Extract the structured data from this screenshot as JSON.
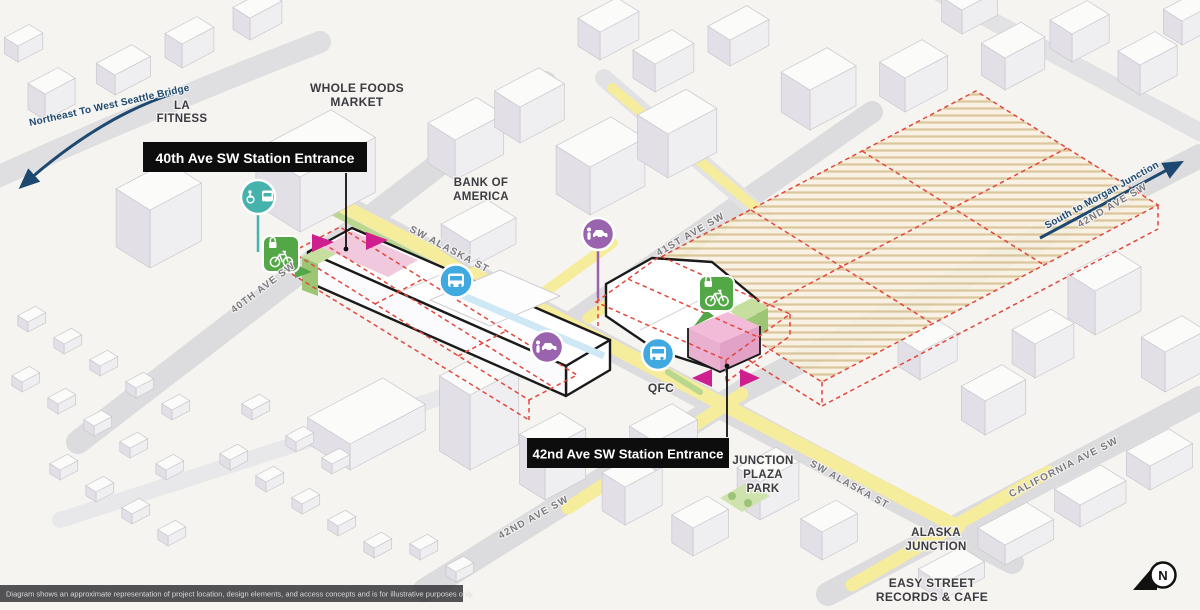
{
  "direction_arrows": {
    "to_west_seattle_bridge": "Northeast To West Seattle Bridge",
    "to_morgan_junction": "South to Morgan Junction"
  },
  "station_entrances": {
    "entrance_40th": "40th Ave SW Station Entrance",
    "entrance_42nd": "42nd Ave SW Station Entrance"
  },
  "streets": {
    "sw_alaska_st_west": "SW ALASKA ST",
    "sw_alaska_st_east": "SW ALASKA ST",
    "ave_40th": "40TH AVE SW",
    "ave_41st": "41ST AVE SW",
    "ave_42nd_south": "42ND AVE SW",
    "ave_42nd_north": "42ND AVE SW",
    "california_ave": "CALIFORNIA AVE SW"
  },
  "places": {
    "la_fitness": [
      "LA",
      "FITNESS"
    ],
    "whole_foods": [
      "WHOLE FOODS",
      "MARKET"
    ],
    "bank_of_america": [
      "BANK OF",
      "AMERICA"
    ],
    "qfc": "QFC",
    "junction_plaza_park": [
      "JUNCTION",
      "PLAZA",
      "PARK"
    ],
    "alaska_junction": [
      "ALASKA",
      "JUNCTION"
    ],
    "easy_street": [
      "EASY STREET",
      "RECORDS & CAFE"
    ]
  },
  "icons": {
    "paratransit_stop": "wheelchair-bus",
    "bus_stop_west": "bus",
    "bus_stop_east": "bus",
    "pickup_dropoff_west": "person-car",
    "pickup_dropoff_east": "person-car",
    "bike_storage_west": "lock-bike",
    "bike_storage_east": "lock-bike"
  },
  "compass": {
    "north_label": "N"
  },
  "footer": {
    "disclaimer": "Diagram shows an approximate representation of project location, design elements, and access concepts and is for illustrative purposes only."
  },
  "colors": {
    "route_yellow": "#f5ec9c",
    "route_green": "#b9d78f",
    "station_pink": "#f1c9de",
    "dashed_red": "#e2473c",
    "bus_blue": "#3fa9e0",
    "paratransit_teal": "#45b3ab",
    "pickup_purple": "#9a63ad",
    "bike_green": "#53a747",
    "arrow_navy": "#1d4971",
    "hatch_tan": "#d8c193"
  }
}
